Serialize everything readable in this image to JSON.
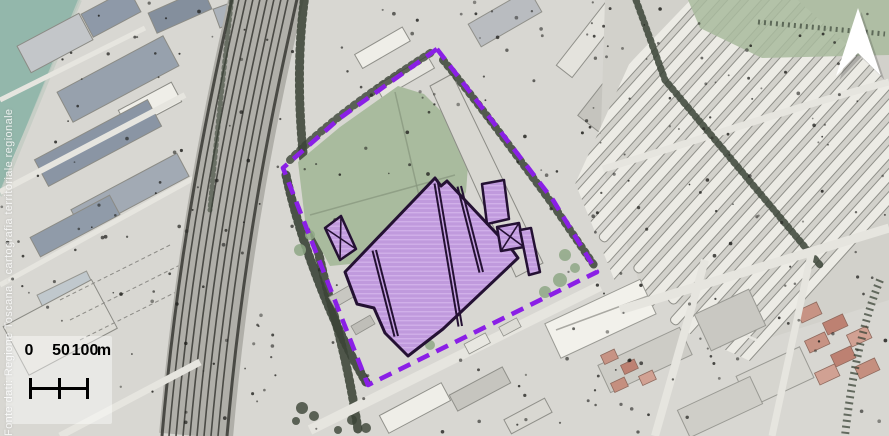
{
  "map": {
    "attribution": "Fonte dati: Regione Toscana - cartografia territoriale regionale",
    "scale_bar": {
      "tick_labels": [
        "0",
        "50",
        "100"
      ],
      "unit": "m"
    },
    "north_arrow_icon": "north-arrow",
    "colors": {
      "base": "#d8d7d2",
      "water": "#93b7ab",
      "grass": "#a9bb9e",
      "trees": "#3b4437",
      "rail": "#4a4a45",
      "railbed": "#b0afa9",
      "road": "#e6e5df",
      "block": "#c7c6c0",
      "bluishroof": "#8e99a8",
      "whiteroof": "#efeee8",
      "salmonroof": "#c79384",
      "boundary": "#8a1fe6",
      "parcelfill": "#c09add",
      "parcelhatch": "#d2b2ea",
      "parceloutline": "#241133"
    }
  }
}
